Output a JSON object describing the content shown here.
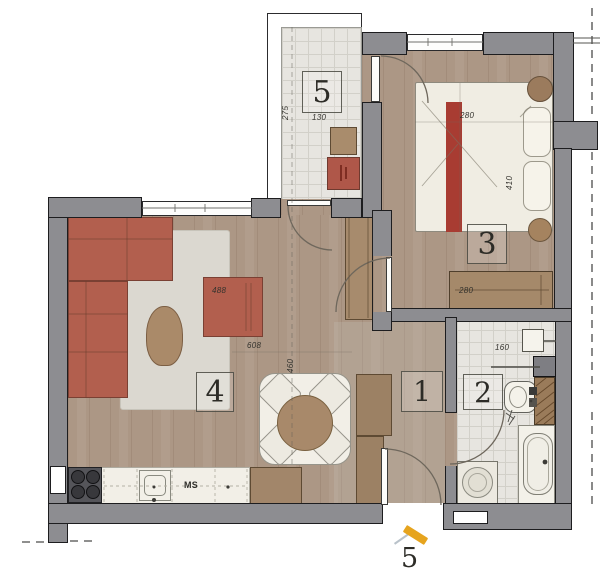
{
  "rooms": {
    "r1": {
      "number": "1",
      "name": "hallway"
    },
    "r2": {
      "number": "2",
      "name": "bathroom"
    },
    "r3": {
      "number": "3",
      "name": "bedroom"
    },
    "r4": {
      "number": "4",
      "name": "living-room"
    },
    "r5": {
      "number": "5",
      "name": "balcony"
    }
  },
  "dims": {
    "balcony_depth": "275",
    "balcony_width": "130",
    "bedroom_width": "280",
    "bedroom_length": "410",
    "wardrobe_length": "280",
    "bathroom_width": "160",
    "sofa_wall": "488",
    "living_width": "608",
    "living_depth": "460"
  },
  "kitchen": {
    "dishwasher_label": "MS"
  },
  "marker": {
    "label": "5"
  },
  "colors": {
    "wall_gray": "#8d8d91",
    "wood_floor": "#ac9785",
    "tile_floor": "#e7e5e0",
    "sofa_terracotta": "#b25f4e",
    "bed_runner": "#a83c32",
    "marker_orange": "#e6a41e"
  }
}
